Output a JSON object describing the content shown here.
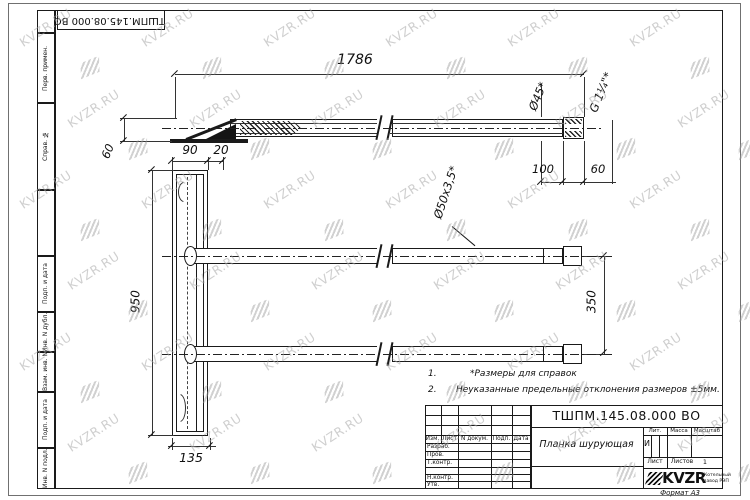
{
  "watermark": {
    "text": "KVZR.RU"
  },
  "stamp_top": {
    "doc_number": "ТШПМ.145.08.000 ВО"
  },
  "margin_labels": {
    "top": [
      "Перв. примен.",
      "Справ. №"
    ],
    "bottom": [
      "Подп. и дата",
      "Инв. N дубл.",
      "Взам. инв. N",
      "Подп. и дата",
      "Инв. N подл."
    ]
  },
  "drawing": {
    "dims": {
      "length_overall": "1786",
      "end_len": "100",
      "end_len2": "60",
      "top_offset": "60",
      "plate_w": "90",
      "plate_offset": "20",
      "plate_height": "950",
      "pipe_gap": "350",
      "plate_bottom": "135"
    },
    "labels": {
      "diameter_45": "Ø45*",
      "thread": "G 1¼\"*",
      "pipe_size": "Ø50x3,5*"
    },
    "notes": [
      {
        "num": "1.",
        "text": "*Размеры для справок"
      },
      {
        "num": "2.",
        "text": "Неуказанные предельные отклонения размеров ±5мм."
      }
    ]
  },
  "title_block": {
    "doc_number": "ТШПМ.145.08.000 ВО",
    "part_name": "Планка шурующая",
    "rev_headers": [
      "Изм.",
      "Лист",
      "N докум.",
      "Подп.",
      "Дата"
    ],
    "staff_rows": [
      "Разраб.",
      "Пров.",
      "Т.контр.",
      "Н.контр.",
      "Утв."
    ],
    "lit_header": "Лит.",
    "lit_value": "И",
    "mass_header": "Масса",
    "scale_header": "Масштаб",
    "sheet_label": "Лист",
    "sheets_label": "Листов",
    "sheets_value": "1",
    "logo_text": "KVZR",
    "logo_sub1": "Котельный",
    "logo_sub2": "завод РЭП",
    "format_label": "Формат А3"
  }
}
